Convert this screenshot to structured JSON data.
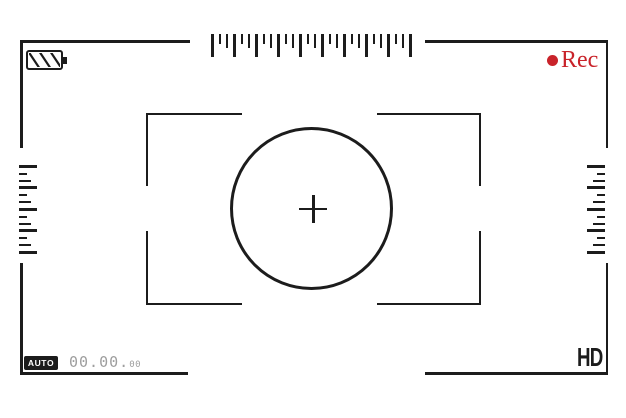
{
  "viewfinder": {
    "background_color": "#ffffff",
    "line_color": "#1c1c1c",
    "top_status": {
      "battery_icon": {
        "stripes": 3
      },
      "rec_indicator": {
        "label": "Rec",
        "color": "#c9232a"
      }
    },
    "rulers": {
      "top": {
        "tick_count": 28
      },
      "left": {
        "tick_count": 13
      },
      "right": {
        "tick_count": 13
      }
    },
    "bottom_status": {
      "mode_badge": "AUTO",
      "counter": {
        "main": "00.00",
        "separator": ".",
        "frames": "00",
        "color": "#9e9e9e"
      },
      "quality": "HD"
    }
  }
}
